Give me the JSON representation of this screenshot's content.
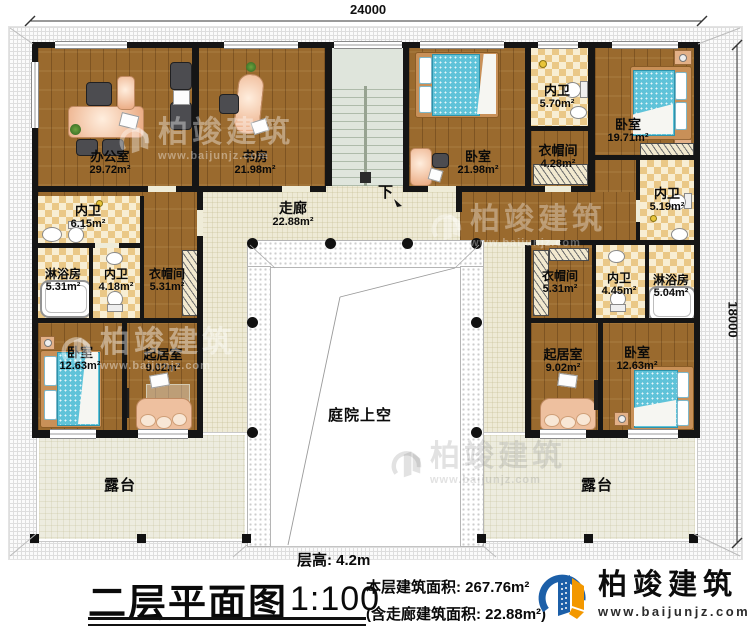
{
  "dimensions": {
    "top": "24000",
    "right": "18000"
  },
  "rooms": {
    "office": {
      "name": "办公室",
      "area": "29.72m²"
    },
    "study": {
      "name": "书房",
      "area": "21.98m²"
    },
    "bedroom_a": {
      "name": "卧室",
      "area": "21.98m²"
    },
    "bath_a": {
      "name": "内卫",
      "area": "5.70m²"
    },
    "bedroom_b": {
      "name": "卧室",
      "area": "19.71m²"
    },
    "cloak_a": {
      "name": "衣帽间",
      "area": "4.28m²"
    },
    "bath_b": {
      "name": "内卫",
      "area": "5.19m²"
    },
    "bath_c": {
      "name": "内卫",
      "area": "6.15m²"
    },
    "corridor": {
      "name": "走廊",
      "area": "22.88m²"
    },
    "shower_left": {
      "name": "淋浴房",
      "area": "5.31m²"
    },
    "bath_left": {
      "name": "内卫",
      "area": "4.18m²"
    },
    "cloak_left": {
      "name": "衣帽间",
      "area": "5.31m²"
    },
    "bedroom_left": {
      "name": "卧室",
      "area": "12.63m²"
    },
    "living_left": {
      "name": "起居室",
      "area": "9.02m²"
    },
    "cloak_right": {
      "name": "衣帽间",
      "area": "5.31m²"
    },
    "bath_right": {
      "name": "内卫",
      "area": "4.45m²"
    },
    "shower_right": {
      "name": "淋浴房",
      "area": "5.04m²"
    },
    "living_right": {
      "name": "起居室",
      "area": "9.02m²"
    },
    "bedroom_right": {
      "name": "卧室",
      "area": "12.63m²"
    },
    "courtyard": {
      "name": "庭院上空"
    },
    "terrace_left": {
      "name": "露台"
    },
    "terrace_right": {
      "name": "露台"
    },
    "stairs": {
      "down_label": "下"
    }
  },
  "title_block": {
    "floor_height": "层高: 4.2m",
    "title": "二层平面图",
    "scale": "1:100",
    "area_line1": "本层建筑面积: 267.76m²",
    "area_line2": "(含走廊建筑面积: 22.88m²)"
  },
  "brand": {
    "name": "柏竣建筑",
    "url": "www.baijunjz.com"
  },
  "watermark": {
    "name": "柏竣建筑",
    "url": "www.baijunjz.com"
  },
  "colors": {
    "wood": "#9a6a2e",
    "tile_dark": "#eac887",
    "tile_light": "#f8eed3",
    "corridor": "#eeead6",
    "wall": "#151515",
    "bed": "#5fc3d9",
    "logo_blue": "#1c5fa8",
    "logo_orange": "#f39800"
  }
}
